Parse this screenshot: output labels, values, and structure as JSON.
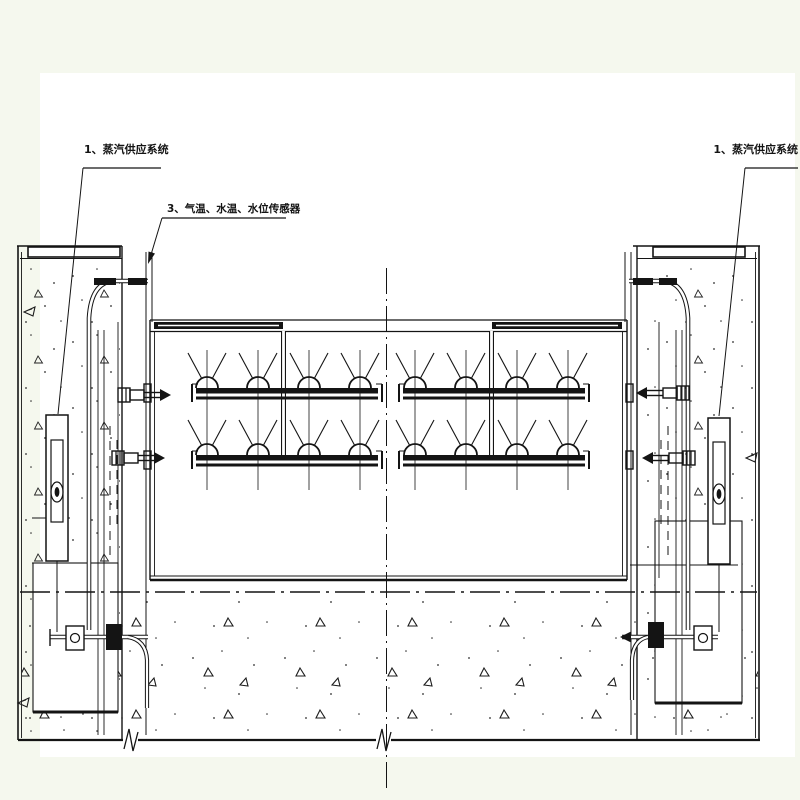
{
  "drawing": {
    "labels": {
      "steam_supply_left": {
        "text": "1、蒸汽供应系统"
      },
      "sensors": {
        "text": "3、气温、水温、水位传感器"
      },
      "steam_supply_right": {
        "text": "1、蒸汽供应系统"
      }
    },
    "structure": {
      "spray_rail_rows": 2,
      "rail_segments_per_row": 2,
      "nozzles_per_segment": 4
    },
    "colors": {
      "background": "#f5f8ee",
      "paper": "#ffffff",
      "line": "#1b1b1b"
    }
  }
}
